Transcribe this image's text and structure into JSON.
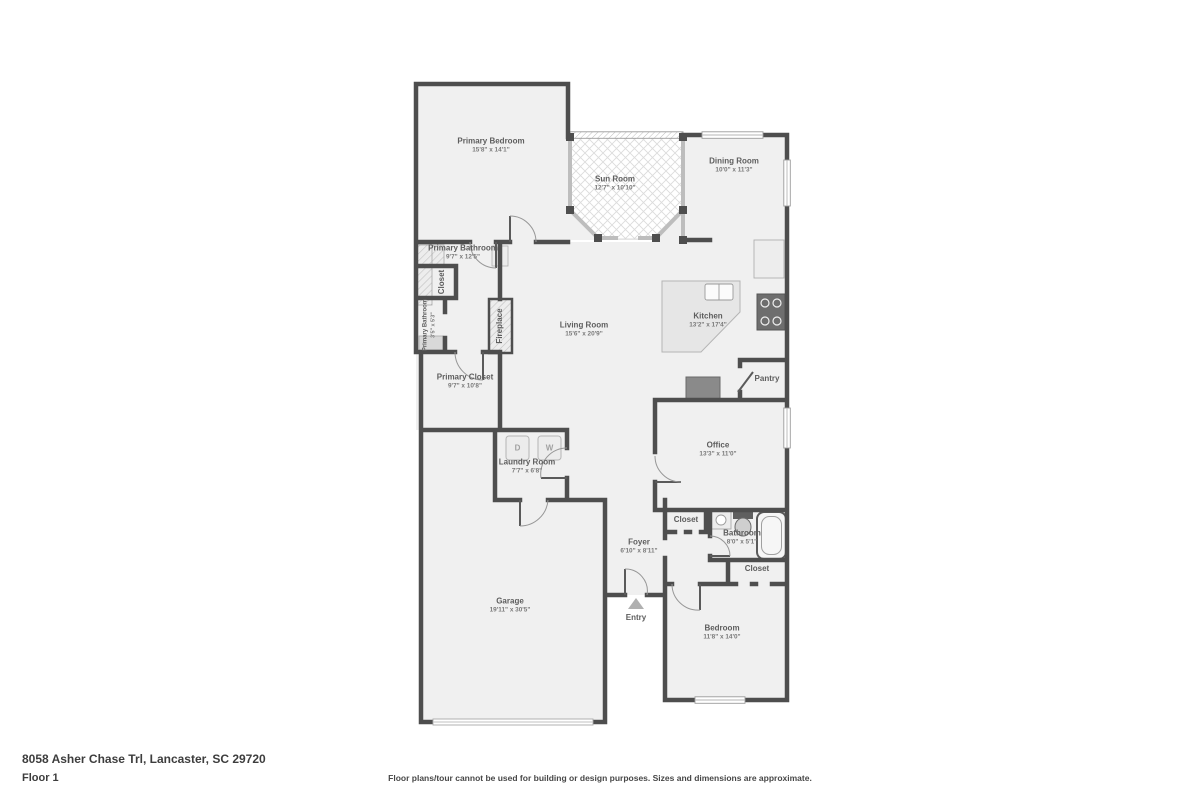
{
  "page": {
    "address": "8058 Asher Chase Trl, Lancaster, SC 29720",
    "floor_label": "Floor 1",
    "disclaimer": "Floor plans/tour cannot be used for building or design purposes. Sizes and dimensions are approximate."
  },
  "colors": {
    "wall": "#4e4e4e",
    "floor": "#f0f0f0",
    "window": "#9c9c9c",
    "label": "#5d5d5d"
  },
  "rooms": {
    "primary_bedroom": {
      "name": "Primary Bedroom",
      "dims": "15'8\" x 14'1\""
    },
    "sun_room": {
      "name": "Sun Room",
      "dims": "12'7\" x 10'10\""
    },
    "dining_room": {
      "name": "Dining Room",
      "dims": "10'0\" x 11'3\""
    },
    "primary_bathroom": {
      "name": "Primary Bathroom",
      "dims": "9'7\" x 12'5\""
    },
    "closet_primary": {
      "name": "Closet",
      "dims": ""
    },
    "primary_bathroom_small": {
      "name": "Primary Bathroom",
      "dims": "3'5\" x 5'3\""
    },
    "fireplace": {
      "name": "Fireplace",
      "dims": ""
    },
    "living_room": {
      "name": "Living Room",
      "dims": "15'6\" x 20'9\""
    },
    "kitchen": {
      "name": "Kitchen",
      "dims": "13'2\" x 17'4\""
    },
    "pantry": {
      "name": "Pantry",
      "dims": ""
    },
    "primary_closet": {
      "name": "Primary Closet",
      "dims": "9'7\" x 10'8\""
    },
    "laundry_room": {
      "name": "Laundry Room",
      "dims": "7'7\" x 6'8\""
    },
    "office": {
      "name": "Office",
      "dims": "13'3\" x 11'0\""
    },
    "hall_closet": {
      "name": "Closet",
      "dims": ""
    },
    "bathroom": {
      "name": "Bathroom",
      "dims": "8'0\" x 5'1\""
    },
    "foyer": {
      "name": "Foyer",
      "dims": "6'10\" x 8'11\""
    },
    "bedroom_closet": {
      "name": "Closet",
      "dims": ""
    },
    "garage": {
      "name": "Garage",
      "dims": "19'11\" x 30'5\""
    },
    "entry": {
      "name": "Entry",
      "dims": ""
    },
    "bedroom": {
      "name": "Bedroom",
      "dims": "11'8\" x 14'0\""
    }
  },
  "appliances": {
    "dryer": "D",
    "washer": "W"
  }
}
